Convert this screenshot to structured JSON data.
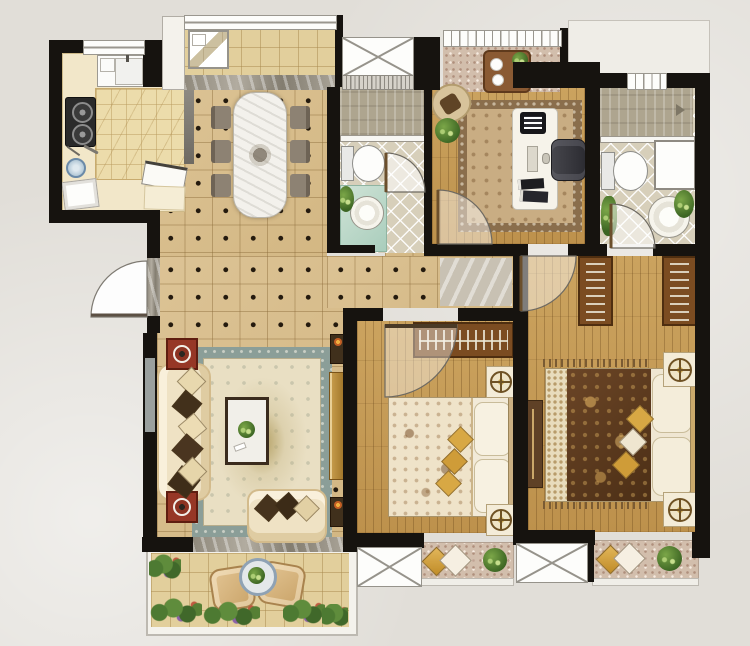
{
  "page": {
    "title": "Three-bedroom apartment floor plan (top view)",
    "canvas": {
      "width": 750,
      "height": 646
    },
    "background": "#e1ded8"
  },
  "palette": {
    "wall": "#16130f",
    "hall_tile": "#d7bd8c",
    "wood_floor": "#c49a58",
    "kitchen_tile": "#ecdcab",
    "bathroom_tile": "#d7cfba",
    "balcony_tile": "#e2cf9c",
    "bay_floral": "#d2beac",
    "rug_border_teal": "#8b9e98",
    "rug_field_cream": "#e9dfc3",
    "accent_red_table": "#963726",
    "quilt_dark_brown": "#5d3b20",
    "gold_cushion": "#d8a844",
    "vanity_teal": "#bedacb"
  },
  "rooms": [
    {
      "id": "kitchen",
      "name": "Kitchen",
      "furniture": [
        "u-shaped-counter",
        "double-sink",
        "gas-stove-2-burners",
        "utensils",
        "blue-pot",
        "dish-trays"
      ]
    },
    {
      "id": "laundry-balcony",
      "name": "Top balcony",
      "furniture": [
        "washing-machine"
      ]
    },
    {
      "id": "dining-room",
      "name": "Dining room",
      "furniture": [
        "marble-dining-table",
        "dining-chairs-x6"
      ]
    },
    {
      "id": "bathroom-main",
      "name": "Main bathroom",
      "furniture": [
        "shower-area",
        "toilet",
        "vanity-washbasin",
        "plant",
        "vent-shaft"
      ]
    },
    {
      "id": "study",
      "name": "Study",
      "furniture": [
        "area-rug",
        "desk",
        "monitor",
        "office-chair",
        "books",
        "rocking-chair",
        "potted-plant"
      ]
    },
    {
      "id": "study-bay",
      "name": "Study bay window",
      "furniture": [
        "tea-table",
        "plates",
        "plant"
      ]
    },
    {
      "id": "bathroom-ensuite",
      "name": "Ensuite bathroom",
      "furniture": [
        "shower-area",
        "toilet",
        "storage-cabinet",
        "round-washbasin",
        "plant"
      ]
    },
    {
      "id": "living-room",
      "name": "Living room",
      "furniture": [
        "three-seat-sofa",
        "loveseat",
        "coffee-table",
        "area-rug",
        "side-table-x2",
        "tv-cabinet",
        "speaker-x2"
      ]
    },
    {
      "id": "bedroom-second",
      "name": "Second bedroom",
      "furniture": [
        "double-bed",
        "wardrobe",
        "nightstand-x2",
        "lamp-x2"
      ]
    },
    {
      "id": "bedroom-master",
      "name": "Master bedroom",
      "furniture": [
        "double-bed",
        "wardrobe-x2",
        "dresser",
        "nightstand-x2",
        "lamp-x2",
        "bedside-rug"
      ]
    },
    {
      "id": "south-balcony",
      "name": "South balcony",
      "furniture": [
        "leisure-chair-x2",
        "round-tea-table",
        "flower-beds"
      ]
    },
    {
      "id": "bay-window-second",
      "name": "Bay window seat",
      "furniture": [
        "cushions",
        "plant"
      ]
    },
    {
      "id": "bay-window-master",
      "name": "Bay window seat",
      "furniture": [
        "cushions",
        "plant"
      ]
    },
    {
      "id": "hallway",
      "name": "Hallway",
      "furniture": []
    },
    {
      "id": "entrance",
      "name": "Entrance door",
      "furniture": [
        "door-swing"
      ]
    }
  ],
  "openings": {
    "doors": [
      "entrance-door",
      "kitchen-sliding-door",
      "bathroom-main-door",
      "study-door",
      "master-bedroom-door",
      "ensuite-bathroom-door",
      "second-bedroom-door"
    ],
    "windows": [
      "kitchen-window",
      "balcony-top-window",
      "vent-shaft-window",
      "study-bay-window",
      "ensuite-window",
      "living-left-window",
      "south-window-x2"
    ]
  }
}
